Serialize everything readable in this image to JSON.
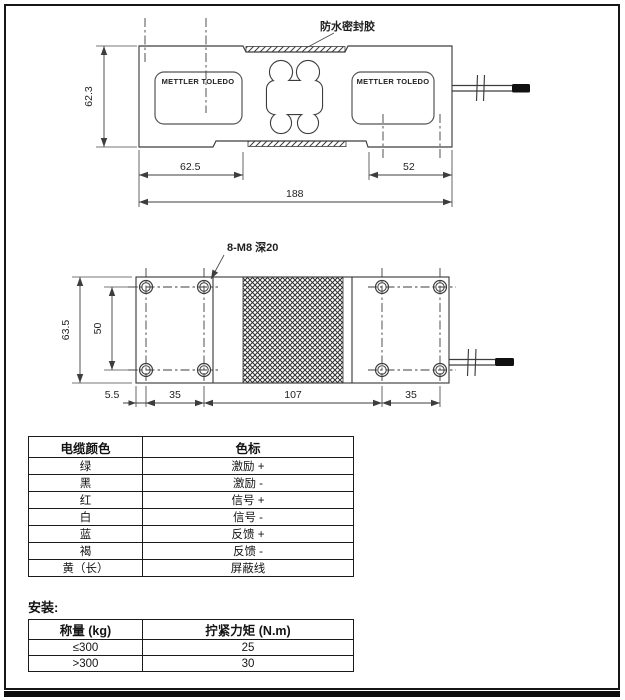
{
  "drawing": {
    "sealant_label": "防水密封胶",
    "bolt_label": "8-M8 深20",
    "brand": "METTLER TOLEDO",
    "side_view_dims": {
      "height": "62.3",
      "left_to_pocket": "62.5",
      "pocket_to_right": "52",
      "total_length": "188"
    },
    "top_view_dims": {
      "width": "63.5",
      "hole_row_span": "50",
      "edge_to_hole": "5.5",
      "hole_pitch_left": "35",
      "center_span": "107",
      "hole_pitch_right": "35"
    }
  },
  "cable_table": {
    "headers": [
      "电缆颜色",
      "色标"
    ],
    "rows": [
      {
        "color": "绿",
        "code": "激励 +"
      },
      {
        "color": "黑",
        "code": "激励 -"
      },
      {
        "color": "红",
        "code": "信号 +"
      },
      {
        "color": "白",
        "code": "信号 -"
      },
      {
        "color": "蓝",
        "code": "反馈 +"
      },
      {
        "color": "褐",
        "code": "反馈 -"
      },
      {
        "color": "黄（长）",
        "code": "屏蔽线"
      }
    ]
  },
  "install": {
    "title": "安装:",
    "headers": [
      "称量 (kg)",
      "拧紧力矩 (N.m)"
    ],
    "rows": [
      {
        "capacity": "≤300",
        "torque": "25"
      },
      {
        "capacity": ">300",
        "torque": "30"
      }
    ]
  }
}
